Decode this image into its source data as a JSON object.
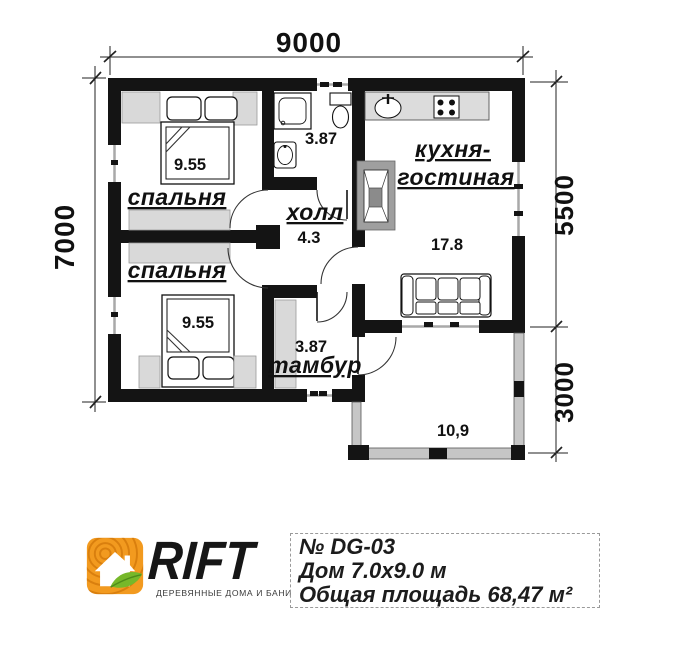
{
  "plan": {
    "dimensions": {
      "top": "9000",
      "left": "7000",
      "right_upper": "5500",
      "right_lower": "3000"
    },
    "rooms": {
      "bedroom1": {
        "label": "спальня",
        "area": "9.55"
      },
      "bedroom2": {
        "label": "спальня",
        "area": "9.55"
      },
      "hall": {
        "label": "холл",
        "area": "4.3"
      },
      "bathroom": {
        "area": "3.87"
      },
      "kitchen_living": {
        "label_line1": "кухня-",
        "label_line2": "гостиная",
        "area": "17.8"
      },
      "vestibule": {
        "label": "тамбур",
        "area": "3.87"
      },
      "terrace": {
        "area": "10,9"
      }
    }
  },
  "footer": {
    "brand": "RIFT",
    "tagline": "ДЕРЕВЯННЫЕ ДОМА И БАНИ",
    "info": {
      "line1": "№ DG-03",
      "line2": "Дом 7.0x9.0 м",
      "line3": "Общая площадь 68,47 м²"
    }
  },
  "colors": {
    "wall": "#141414",
    "furniture_gray": "#d9d9d9",
    "terrace_gray": "#c6c6c6",
    "logo_orange": "#f29a1f",
    "logo_green": "#76b82a"
  }
}
